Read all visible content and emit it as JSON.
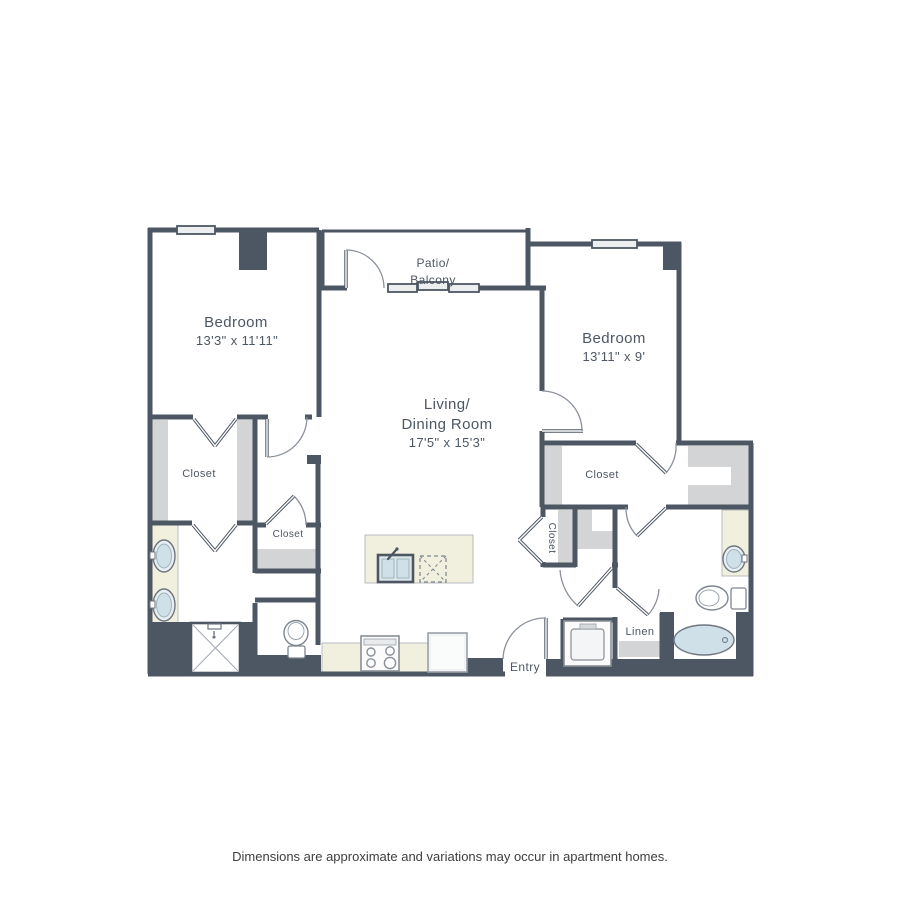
{
  "floor_plan": {
    "labels": {
      "bedroom1": {
        "name": "Bedroom",
        "dims": "13'3\" x 11'11\""
      },
      "bedroom2": {
        "name": "Bedroom",
        "dims": "13'11\" x 9'"
      },
      "living": {
        "line1": "Living/",
        "line2": "Dining Room",
        "dims": "17'5\" x 15'3\""
      },
      "patio": {
        "line1": "Patio/",
        "line2": "Balcony"
      },
      "closet_bedroom1": "Closet",
      "closet_hall": "Closet",
      "closet_bedroom2": "Closet",
      "closet_small": "Closet",
      "linen": "Linen",
      "entry": "Entry"
    },
    "colors": {
      "wall": "#4d5763",
      "shelf_gray": "#d3d4d6",
      "counter_beige": "#f1efdd",
      "fixture_blue": "#cfe0e8",
      "window_fill": "#eceeef",
      "label_text": "#4d5763",
      "disclaimer_text": "#3e3e3e"
    },
    "disclaimer": "Dimensions are approximate and variations may occur in apartment homes."
  }
}
